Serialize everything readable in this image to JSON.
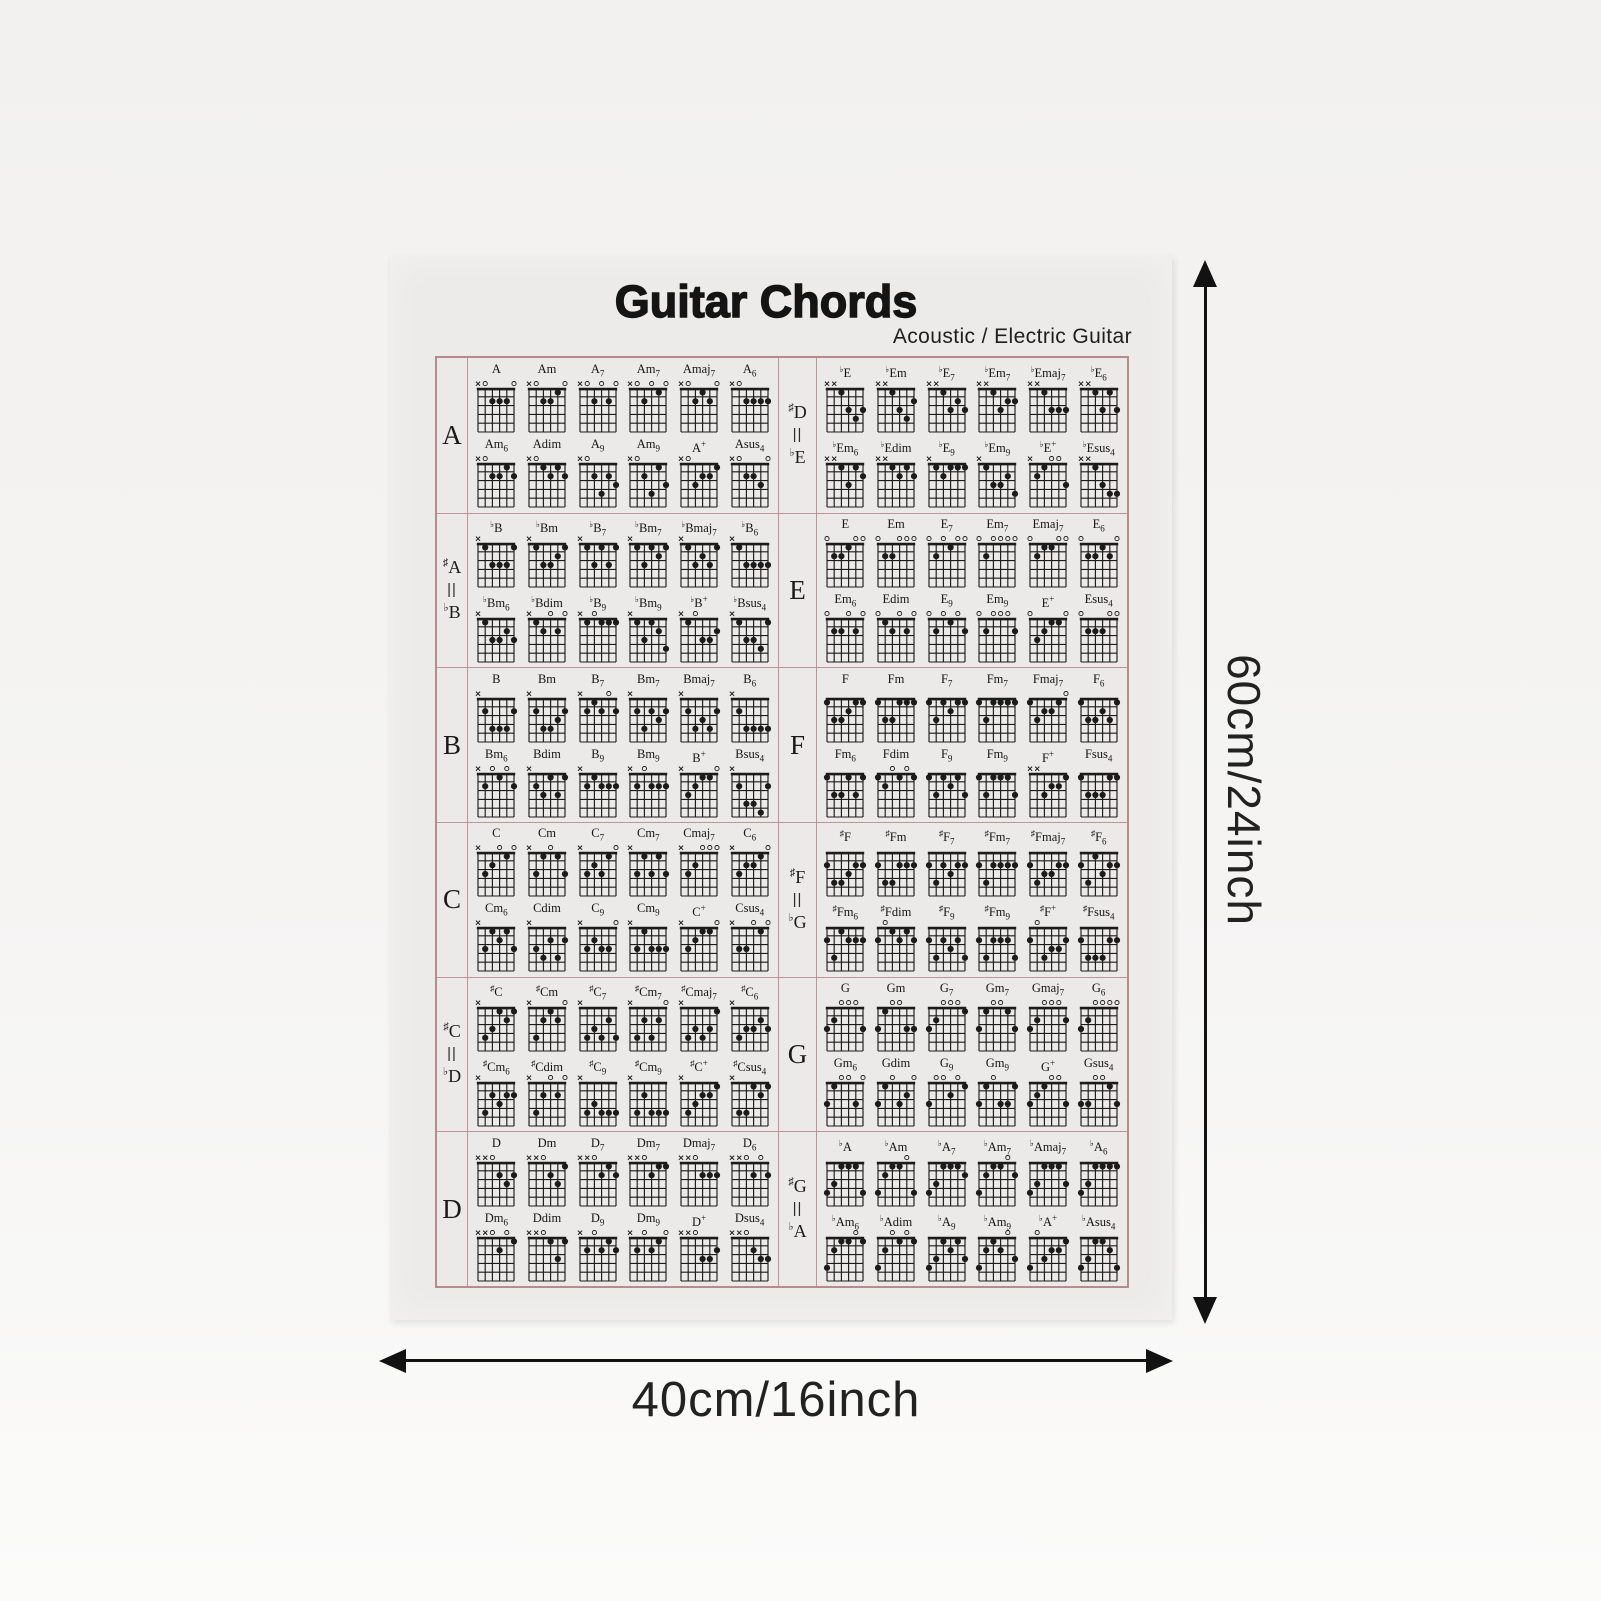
{
  "poster": {
    "title": "Guitar Chords",
    "subtitle": "Acoustic / Electric Guitar",
    "border_color": "#b98a8a",
    "chord_types": [
      {
        "suf": "",
        "sub": "",
        "sup": ""
      },
      {
        "suf": "m",
        "sub": "",
        "sup": ""
      },
      {
        "suf": "",
        "sub": "7",
        "sup": ""
      },
      {
        "suf": "m",
        "sub": "7",
        "sup": ""
      },
      {
        "suf": "maj",
        "sub": "7",
        "sup": ""
      },
      {
        "suf": "",
        "sub": "6",
        "sup": ""
      },
      {
        "suf": "m",
        "sub": "6",
        "sup": ""
      },
      {
        "suf": "dim",
        "sub": "",
        "sup": ""
      },
      {
        "suf": "",
        "sub": "9",
        "sup": ""
      },
      {
        "suf": "m",
        "sub": "9",
        "sup": ""
      },
      {
        "suf": "",
        "sub": "",
        "sup": "+"
      },
      {
        "suf": "sus",
        "sub": "4",
        "sup": ""
      }
    ],
    "sections": [
      {
        "id": "A",
        "labels": [
          {
            "acc": "",
            "letter": "A"
          }
        ],
        "root": {
          "acc": "",
          "letter": "A"
        },
        "frets": [
          "x02220",
          "x02210",
          "x02020",
          "x02010",
          "x02120",
          "x02222",
          "x02212",
          "x01212",
          "x02423",
          "x02413",
          "x03221",
          "x02230"
        ]
      },
      {
        "id": "Eb",
        "labels": [
          {
            "acc": "♯",
            "letter": "D"
          },
          {
            "acc": "♭",
            "letter": "E"
          }
        ],
        "root": {
          "acc": "♭",
          "letter": "E"
        },
        "frets": [
          "xx1343",
          "xx1342",
          "xx1323",
          "xx1322",
          "xx1333",
          "xx1313",
          "xx1312",
          "xx1212",
          "x12111",
          "x13324",
          "x21003",
          "xx1344"
        ]
      },
      {
        "id": "Bb",
        "labels": [
          {
            "acc": "♯",
            "letter": "A"
          },
          {
            "acc": "♭",
            "letter": "B"
          }
        ],
        "root": {
          "acc": "♭",
          "letter": "B"
        },
        "frets": [
          "x13331",
          "x13321",
          "x13131",
          "x13121",
          "x13231",
          "x13333",
          "x13323",
          "x12020",
          "x10111",
          "x13124",
          "x10332",
          "x13341"
        ]
      },
      {
        "id": "E",
        "labels": [
          {
            "acc": "",
            "letter": "E"
          }
        ],
        "root": {
          "acc": "",
          "letter": "E"
        },
        "frets": [
          "022100",
          "022000",
          "020100",
          "020000",
          "021100",
          "022120",
          "022020",
          "012020",
          "020102",
          "020002",
          "032110",
          "022200"
        ]
      },
      {
        "id": "B",
        "labels": [
          {
            "acc": "",
            "letter": "B"
          }
        ],
        "root": {
          "acc": "",
          "letter": "B"
        },
        "frets": [
          "x24442",
          "x24432",
          "x21202",
          "x24232",
          "x24342",
          "x24444",
          "x20102",
          "x23131",
          "x21222",
          "x20222",
          "x32110",
          "x24452"
        ]
      },
      {
        "id": "F",
        "labels": [
          {
            "acc": "",
            "letter": "F"
          }
        ],
        "root": {
          "acc": "",
          "letter": "F"
        },
        "frets": [
          "133211",
          "133111",
          "131211",
          "131111",
          "132210",
          "133231",
          "133131",
          "120101",
          "131213",
          "131113",
          "xx3221",
          "133311"
        ]
      },
      {
        "id": "C",
        "labels": [
          {
            "acc": "",
            "letter": "C"
          }
        ],
        "root": {
          "acc": "",
          "letter": "C"
        },
        "frets": [
          "x32010",
          "x31013",
          "x32310",
          "x31313",
          "x32000",
          "x32210",
          "x31213",
          "x34242",
          "x32330",
          "x31333",
          "x32110",
          "x33010"
        ]
      },
      {
        "id": "Fsharp",
        "labels": [
          {
            "acc": "♯",
            "letter": "F"
          },
          {
            "acc": "♭",
            "letter": "G"
          }
        ],
        "root": {
          "acc": "♯",
          "letter": "F"
        },
        "frets": [
          "244322",
          "244222",
          "242322",
          "242222",
          "243322",
          "241322",
          "241222",
          "201212",
          "242324",
          "242224",
          "204332",
          "244422"
        ]
      },
      {
        "id": "Csharp",
        "labels": [
          {
            "acc": "♯",
            "letter": "C"
          },
          {
            "acc": "♭",
            "letter": "D"
          }
        ],
        "root": {
          "acc": "♯",
          "letter": "C"
        },
        "frets": [
          "x43121",
          "x42120",
          "x43424",
          "x42420",
          "x43431",
          "x43323",
          "x42322",
          "x42020",
          "x43444",
          "x42444",
          "x43221",
          "x44121"
        ]
      },
      {
        "id": "G",
        "labels": [
          {
            "acc": "",
            "letter": "G"
          }
        ],
        "root": {
          "acc": "",
          "letter": "G"
        },
        "frets": [
          "320003",
          "310033",
          "320001",
          "310013",
          "320002",
          "320000",
          "310030",
          "310320",
          "300201",
          "310331",
          "321003",
          "330013"
        ]
      },
      {
        "id": "D",
        "labels": [
          {
            "acc": "",
            "letter": "D"
          }
        ],
        "root": {
          "acc": "",
          "letter": "D"
        },
        "frets": [
          "xx0232",
          "xx0231",
          "xx0212",
          "xx0211",
          "xx0222",
          "xx0202",
          "xx0201",
          "xx0131",
          "x20212",
          "x20210",
          "xx0332",
          "xx0233"
        ]
      },
      {
        "id": "Ab",
        "labels": [
          {
            "acc": "♯",
            "letter": "G"
          },
          {
            "acc": "♭",
            "letter": "A"
          }
        ],
        "root": {
          "acc": "♭",
          "letter": "A"
        },
        "frets": [
          "431114",
          "421104",
          "431112",
          "421102",
          "431113",
          "431111",
          "421101",
          "420101",
          "431213",
          "421203",
          "403221",
          "431124"
        ]
      }
    ]
  },
  "dimensions": {
    "height_label": "60cm/24inch",
    "width_label": "40cm/16inch"
  }
}
